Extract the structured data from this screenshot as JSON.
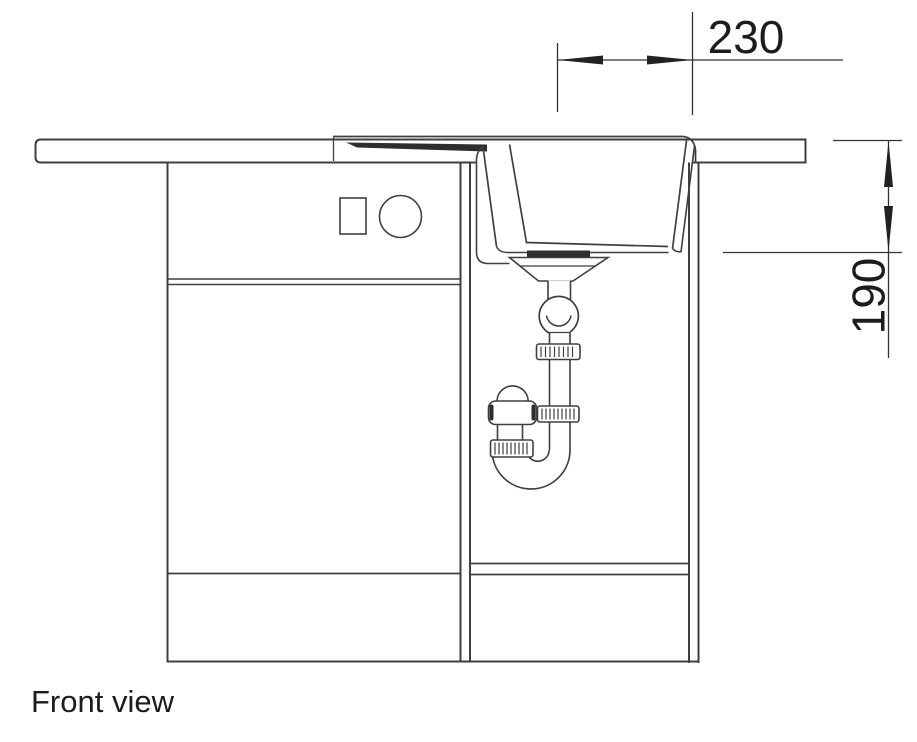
{
  "drawing": {
    "caption": "Front view",
    "dimensions": {
      "horizontal_mm": "230",
      "vertical_mm": "190"
    },
    "colors": {
      "line": "#3f3f3f",
      "dimension_line": "#333333",
      "fill_dark": "#2e2e2e",
      "text": "#1c1c1c",
      "background": "#ffffff"
    }
  }
}
